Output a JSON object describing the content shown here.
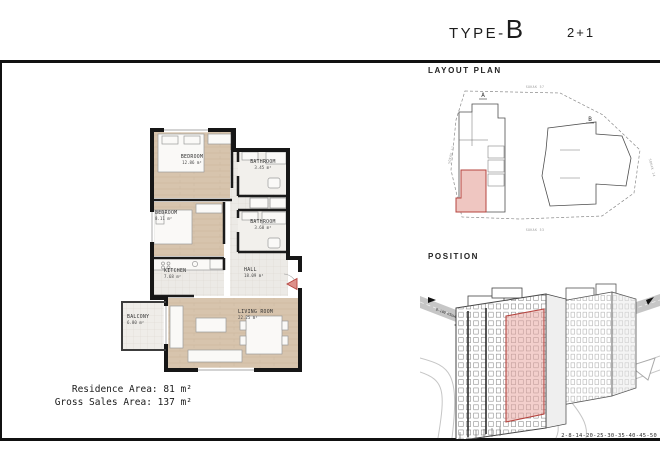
{
  "header": {
    "type_prefix": "TYPE-",
    "type_letter": "B",
    "unit_config": "2+1"
  },
  "floor_plan": {
    "rooms": [
      {
        "name": "BEDROOM",
        "area": "12.86 m²"
      },
      {
        "name": "BATHROOM",
        "area": "3.45 m²"
      },
      {
        "name": "BEDROOM",
        "area": "8.11 m²"
      },
      {
        "name": "BATHROOM",
        "area": "3.60 m²"
      },
      {
        "name": "KITCHEN",
        "area": "7.68 m²"
      },
      {
        "name": "HALL",
        "area": "18.09 m²"
      },
      {
        "name": "LIVING ROOM",
        "area": "22.25 m²"
      },
      {
        "name": "BALCONY",
        "area": "6.80 m²"
      }
    ],
    "summary": {
      "residence_label": "Residence Area:",
      "residence_value": "81 m²",
      "gross_label": "Gross Sales Area:",
      "gross_value": "137 m²"
    }
  },
  "layout_plan": {
    "title": "LAYOUT PLAN",
    "block_a_label": "A",
    "block_b_label": "B",
    "street_top": "SOKAK 57",
    "street_bottom": "SOKAK 53",
    "street_left": "SOKAK 11",
    "street_right": "SOKAK 14"
  },
  "position": {
    "title": "POSITION",
    "highway_label_left": "D-100 HIGHWAY",
    "highway_label_right": "D-100 HIGHWAY",
    "floor_numbers": "2-8-14-20-25-30-35-40-45-50"
  },
  "colors": {
    "wall": "#1a1a1a",
    "wood_floor": "#d7c4ad",
    "tile_floor": "#eceae6",
    "highlight_pink": "#eec2bd",
    "highlight_red": "#b5443f"
  }
}
